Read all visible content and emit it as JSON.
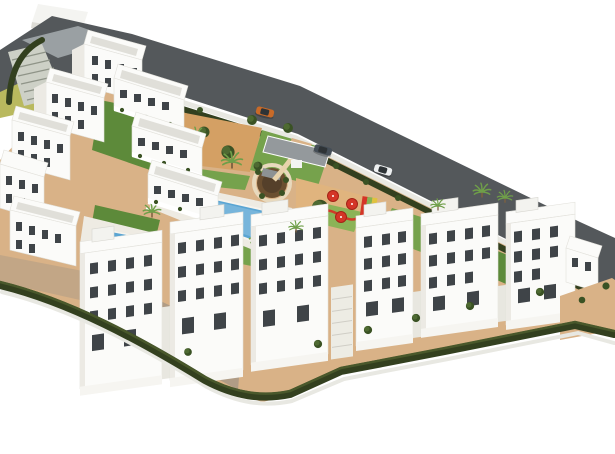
{
  "scene": {
    "type": "3d-architectural-render",
    "subject": "aerial view of a white residential apartment complex with communal gardens and pool",
    "elements": [
      "foreground-apartment-blocks",
      "hillside-apartment-cluster",
      "communal-pool",
      "small-pool",
      "pool-island-with-loungers",
      "round-plaza-pergola",
      "playground",
      "red-shade-umbrellas",
      "perimeter-road",
      "roadside-hedge",
      "boundary-hedge",
      "carport-entrance",
      "palm-trees",
      "olive-trees",
      "terraced-steps",
      "sandy-paths"
    ],
    "counts": {
      "foreground_blocks": 6,
      "cars": 3,
      "red_umbrellas": 3,
      "pools": 2
    }
  },
  "colors": {
    "background": "#ffffff",
    "road": "#54585b",
    "road_light": "#9aa0a3",
    "wall": "#e8e8e2",
    "hedge": "#33401f",
    "hedge_light": "#49582b",
    "lawn": "#76a24c",
    "lawn_dark": "#5d8a3a",
    "sand": "#d9b287",
    "sand_orange": "#d4a064",
    "sand_play": "#e0b47e",
    "deck": "#eeebe3",
    "water": "#5aa5d3",
    "water_light": "#93c6e4",
    "building": "#fbfbf9",
    "building_shade": "#eceae4",
    "building_dark": "#d9d8d2",
    "window": "#3f4448",
    "roof_deck": "#e0dfd9",
    "shadow": "#8e8b84",
    "plaza_brown": "#6b4f30",
    "plaza_dark": "#55402a",
    "red": "#d43527",
    "play_green": "#86b355",
    "play_yellow": "#e0c23f",
    "car_orange": "#c96a28",
    "car_dark": "#454e57",
    "car_white": "#eef0f1",
    "glass": "#2e3336",
    "tree": "#4e6a32",
    "tree_dark": "#3a5224",
    "palm": "#6f9f49",
    "trunk": "#7d6140",
    "steps": "#cdd0c6",
    "terrace_green": "#b9b95e"
  }
}
